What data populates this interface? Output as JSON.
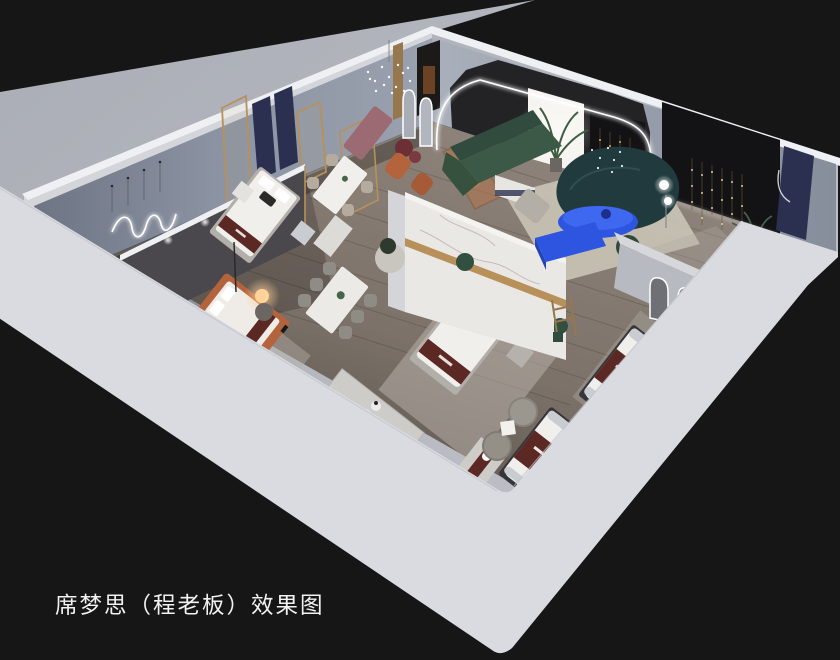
{
  "meta": {
    "scene": "isometric dollhouse cutaway 3D render of a Simmons mattress showroom",
    "background_style": "dark studio backdrop"
  },
  "caption": {
    "text": "席梦思（程老板）效果图"
  },
  "palette": {
    "background": "#161616",
    "apron": "#b4b7be",
    "wall_outer": "#d3d5da",
    "wall_top": "#eef0f3",
    "band": "#d9dbe0",
    "floor_light": "#8a8077",
    "partition_dark": "#4a484c",
    "marble": "#eae8e4",
    "gold": "#b8905a",
    "navy": "#2b3050",
    "maroon": "#5c2823",
    "green_sofa": "#3c5847",
    "teal_sofa": "#213a3d",
    "blue": "#2e55df",
    "mauve": "#9c6a72",
    "orange_bed": "#b4643c",
    "amber_glass": "#b4744a",
    "dark_panel": "#131315",
    "rug": "#c7c2b8",
    "rug_living": "#cac4b6",
    "mattress": "#f0efec",
    "gray_furniture": "#a8a49e",
    "chair_gray": "#8f8b85",
    "chair_beige": "#b5ac9f",
    "plant": "#47634a",
    "wood": "#96774e",
    "stone": "#cdccc8",
    "led": "#ffffff",
    "warm_light": "#ffcf96"
  },
  "objects": [
    "bedroom display with navy fabric panels and brass glass screens",
    "marble feature wall with brass inlay",
    "queen beds with branded burgundy foot runners",
    "marble dining table with six chairs",
    "dining table with four chairs",
    "green sectional sofa",
    "curved dark-teal sofa",
    "cobalt oval coffee table and media bench",
    "arched LED portal wall with backlit niche and palm",
    "black feature walls with cascading string lights",
    "arched floor mirrors",
    "terracotta platform bed with glowing sphere lamp",
    "wave neon wall light and crystal chandeliers",
    "branded mattress floor displays",
    "boucle tub chairs and stone display plinths"
  ]
}
